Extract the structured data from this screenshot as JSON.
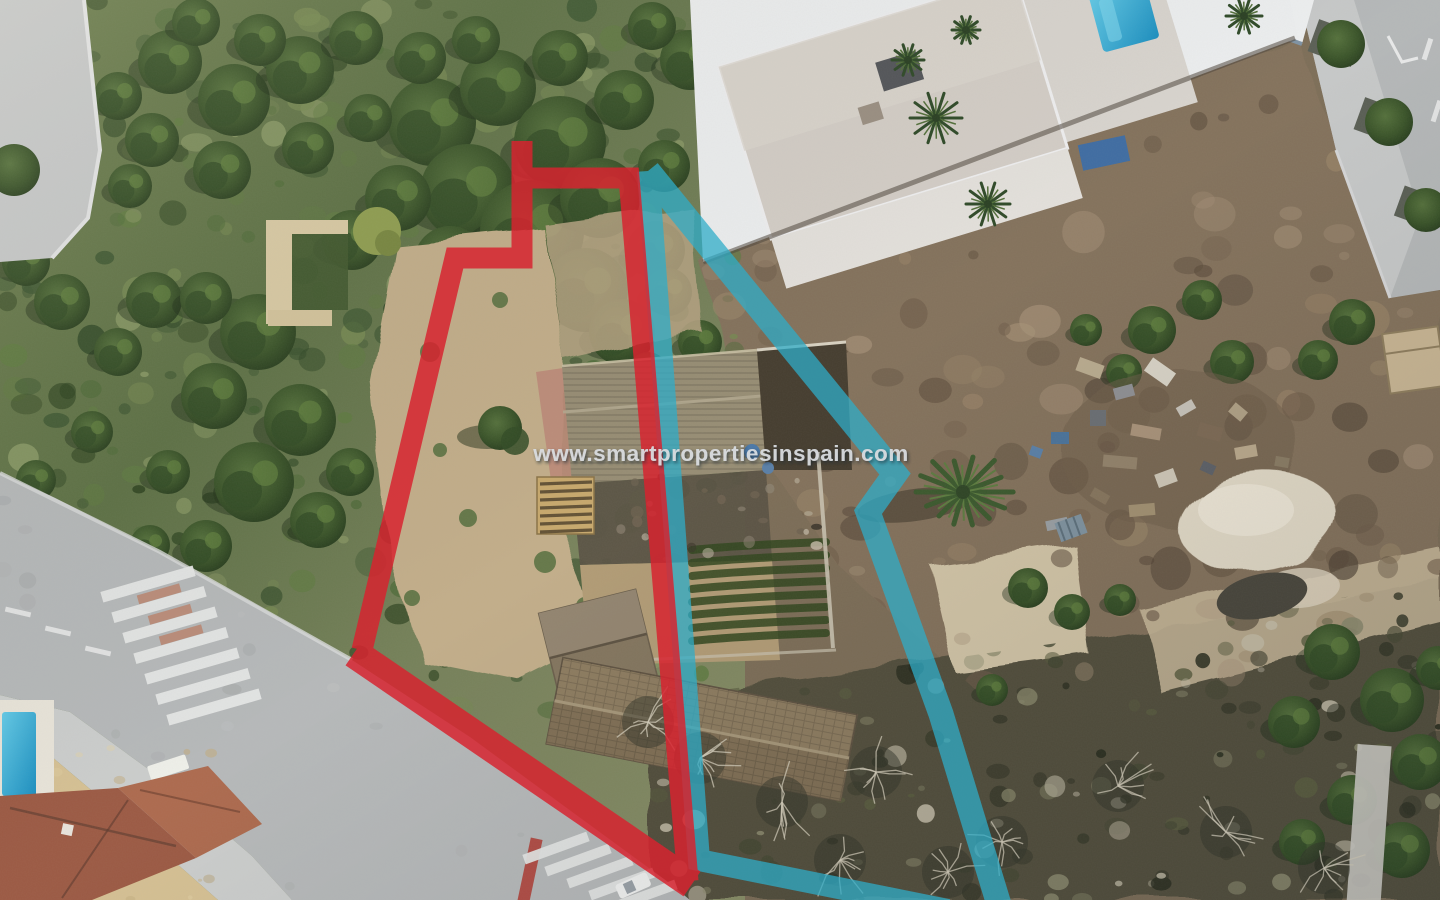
{
  "watermark": {
    "text": "www.smartpropertiesinspain.com",
    "color": "#d8dbdf"
  },
  "overlays": {
    "red_plot_boundary": {
      "color": "#d8232f",
      "opacity": 0.84
    },
    "blue_plot_boundary": {
      "color": "#2fadc9",
      "opacity": 0.74
    }
  },
  "scene": {
    "type": "aerial-drone-photo-of-building-plot",
    "villa_pool_color": "#2fb3d9",
    "garden_pool_color": "#2f9fd6",
    "road_color": "#b6b9ba",
    "dirt_color": "#84725c",
    "scrub_color": "#52503d"
  }
}
